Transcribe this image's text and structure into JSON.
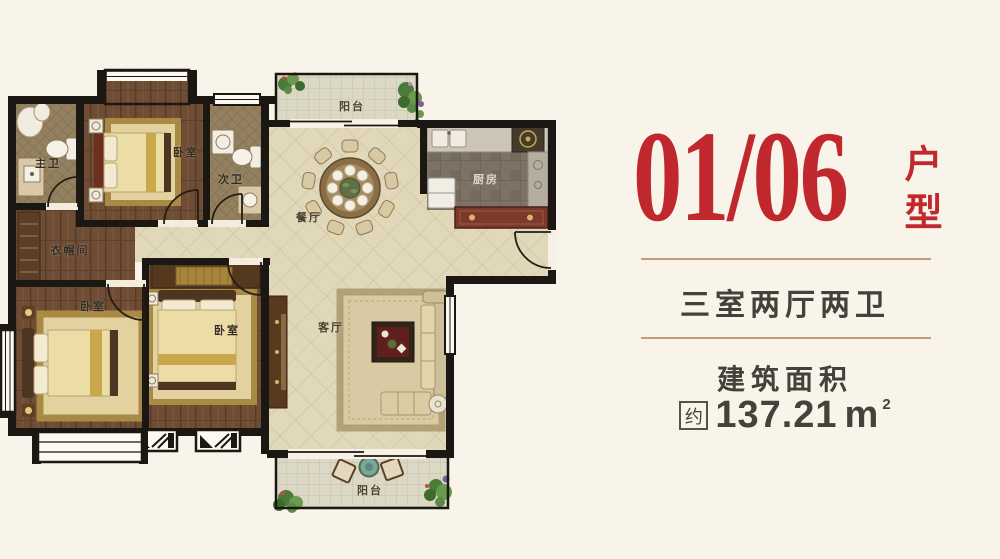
{
  "panel": {
    "unit_number": "01/06",
    "unit_type_label": "户型",
    "layout_summary": "三室两厅两卫",
    "area_title": "建筑面积",
    "area_approx": "约",
    "area_value": "137.21",
    "area_unit": "m",
    "area_superscript": "2"
  },
  "floor_plan": {
    "room_labels": {
      "master_bath": "主卫",
      "bedroom_top": "卧室",
      "second_bath": "次卫",
      "balcony_top": "阳台",
      "dining": "餐厅",
      "kitchen": "厨房",
      "cloakroom": "衣帽间",
      "bedroom_left": "卧室",
      "bedroom_middle": "卧室",
      "living": "客厅",
      "balcony_bottom": "阳台"
    }
  },
  "colors": {
    "background": "#f8f4e9",
    "accent_red": "#c0282e",
    "text_gray": "#45403a",
    "divider_tan": "#c49d74",
    "wall_black": "#1b1713"
  }
}
